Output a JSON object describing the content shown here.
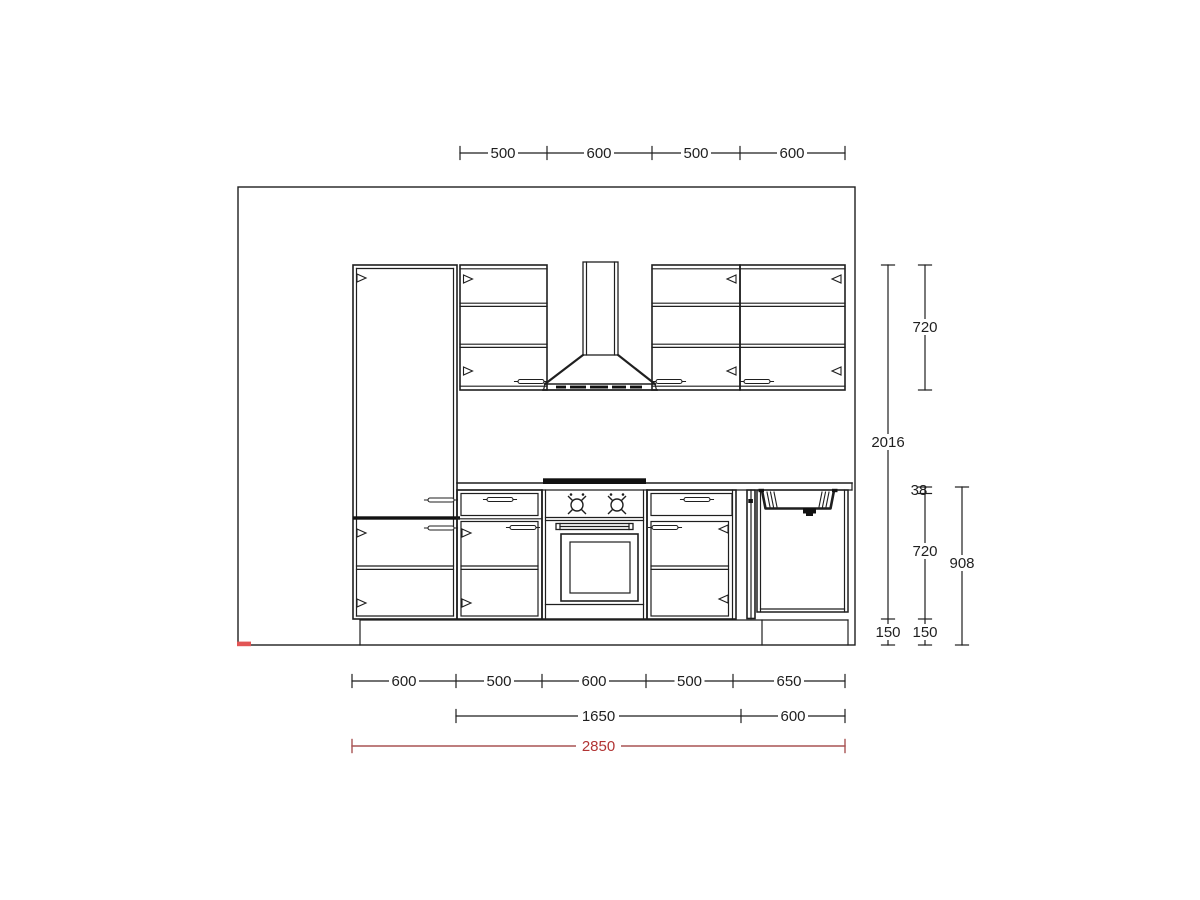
{
  "dims": {
    "top": [
      "500",
      "600",
      "500",
      "600"
    ],
    "bottom_units": [
      "600",
      "500",
      "600",
      "500",
      "650"
    ],
    "bottom_groups": [
      "1650",
      "600"
    ],
    "bottom_total": "2850",
    "right": {
      "wall_cab_height": "720",
      "tall_height": "2016",
      "worktop_thickness": "38",
      "base_height": "720",
      "worktop_height": "908",
      "plinth_left": "150",
      "plinth_right": "150"
    }
  },
  "colors": {
    "line": "#1f1f1f",
    "dim_red_line": "#a85454",
    "dim_red_text": "#b13434",
    "origin_mark": "#e25555"
  }
}
